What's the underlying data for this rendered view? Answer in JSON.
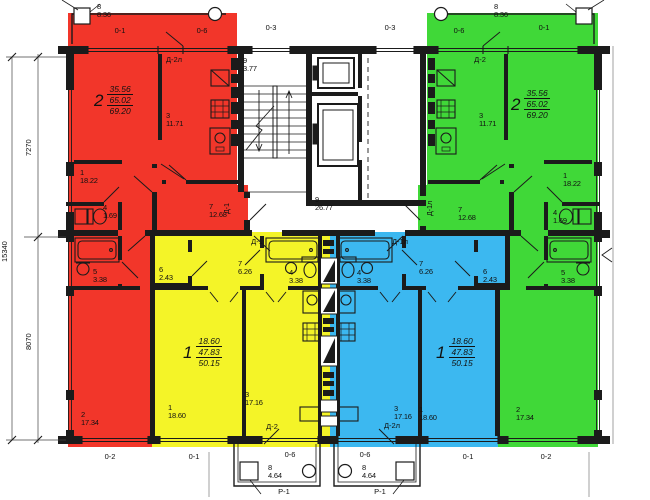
{
  "title": "Typical floor plan — 4 apartments",
  "colors": {
    "red": "#f2362a",
    "yellow": "#f4f428",
    "green": "#40d838",
    "blue": "#3cb8f0",
    "line": "#1b1b1b"
  },
  "apartments": [
    {
      "number": "2",
      "living_area": "35.56",
      "area": "47.83_no",
      "values": [
        "35.56",
        "65.02",
        "69.20"
      ],
      "color": "red",
      "x": 94,
      "y": 84
    },
    {
      "number": "2",
      "values": [
        "35.56",
        "65.02",
        "69.20"
      ],
      "color": "green",
      "x": 511,
      "y": 88
    },
    {
      "number": "1",
      "values": [
        "18.60",
        "47.83",
        "50.15"
      ],
      "color": "yellow",
      "x": 183,
      "y": 336
    },
    {
      "number": "1",
      "values": [
        "18.60",
        "47.83",
        "50.15"
      ],
      "color": "blue",
      "x": 436,
      "y": 336
    }
  ],
  "rooms": [
    {
      "num": "8",
      "area": "8.36",
      "x": 97,
      "y": 3
    },
    {
      "num": "8",
      "area": "8.36",
      "x": 494,
      "y": 3
    },
    {
      "num": "9",
      "area": "3.77",
      "x": 243,
      "y": 57
    },
    {
      "num": "9",
      "area": "26.77",
      "x": 315,
      "y": 196
    },
    {
      "num": "3",
      "area": "11.71",
      "x": 166,
      "y": 112
    },
    {
      "num": "3",
      "area": "11.71",
      "x": 479,
      "y": 112
    },
    {
      "num": "1",
      "area": "18.22",
      "x": 80,
      "y": 169
    },
    {
      "num": "1",
      "area": "18.22",
      "x": 563,
      "y": 172
    },
    {
      "num": "4",
      "area": "1.69",
      "x": 103,
      "y": 204
    },
    {
      "num": "4",
      "area": "1.69",
      "x": 553,
      "y": 209
    },
    {
      "num": "7",
      "area": "12.68",
      "x": 209,
      "y": 203
    },
    {
      "num": "7",
      "area": "12.68",
      "x": 458,
      "y": 206
    },
    {
      "num": "5",
      "area": "3.38",
      "x": 93,
      "y": 268
    },
    {
      "num": "5",
      "area": "3.38",
      "x": 561,
      "y": 269
    },
    {
      "num": "2",
      "area": "17.34",
      "x": 81,
      "y": 411
    },
    {
      "num": "2",
      "area": "17.34",
      "x": 516,
      "y": 406
    },
    {
      "num": "6",
      "area": "2.43",
      "x": 159,
      "y": 266
    },
    {
      "num": "6",
      "area": "2.43",
      "x": 483,
      "y": 268
    },
    {
      "num": "7",
      "area": "6.26",
      "x": 238,
      "y": 260
    },
    {
      "num": "7",
      "area": "6.26",
      "x": 419,
      "y": 260
    },
    {
      "num": "4",
      "area": "3.38",
      "x": 289,
      "y": 269
    },
    {
      "num": "4",
      "area": "3.38",
      "x": 357,
      "y": 269
    },
    {
      "num": "3",
      "area": "17.16",
      "x": 245,
      "y": 391
    },
    {
      "num": "3",
      "area": "17.16",
      "x": 394,
      "y": 405
    },
    {
      "num": "1",
      "area": "18.60",
      "x": 168,
      "y": 404
    },
    {
      "num": "1",
      "area": "18.60",
      "x": 419,
      "y": 406
    },
    {
      "num": "8",
      "area": "4.64",
      "x": 268,
      "y": 464
    },
    {
      "num": "8",
      "area": "4.64",
      "x": 362,
      "y": 464
    }
  ],
  "marks": {
    "windows": [
      {
        "label": "0-1",
        "x": 120,
        "y": 27
      },
      {
        "label": "0-6",
        "x": 202,
        "y": 27
      },
      {
        "label": "0-3",
        "x": 271,
        "y": 24
      },
      {
        "label": "0-3",
        "x": 390,
        "y": 24
      },
      {
        "label": "0-6",
        "x": 459,
        "y": 27
      },
      {
        "label": "0-1",
        "x": 544,
        "y": 24
      },
      {
        "label": "0-2",
        "x": 110,
        "y": 453
      },
      {
        "label": "0-1",
        "x": 194,
        "y": 453
      },
      {
        "label": "0-6",
        "x": 290,
        "y": 451
      },
      {
        "label": "0-6",
        "x": 365,
        "y": 451
      },
      {
        "label": "0-1",
        "x": 468,
        "y": 453
      },
      {
        "label": "0-2",
        "x": 546,
        "y": 453
      }
    ],
    "doors": [
      {
        "label": "Д-2л",
        "x": 174,
        "y": 56
      },
      {
        "label": "Д-2",
        "x": 480,
        "y": 56
      },
      {
        "label": "Д-1",
        "x": 257,
        "y": 238
      },
      {
        "label": "Д-1л",
        "x": 400,
        "y": 238
      },
      {
        "label": "Д-2",
        "x": 272,
        "y": 423
      },
      {
        "label": "Д-2л",
        "x": 392,
        "y": 422
      }
    ],
    "doors_vertical": [
      {
        "label": "Д-1",
        "x": 224,
        "y": 214
      },
      {
        "label": "Д-1л",
        "x": 427,
        "y": 216
      }
    ],
    "balconies": [
      {
        "label": "Р-1",
        "x": 284,
        "y": 488
      },
      {
        "label": "Р-1",
        "x": 380,
        "y": 488
      }
    ]
  },
  "dimensions": [
    {
      "text": "7270",
      "x": 25,
      "y": 156
    },
    {
      "text": "8070",
      "x": 25,
      "y": 350
    },
    {
      "text": "15340",
      "x": 1,
      "y": 262
    }
  ]
}
